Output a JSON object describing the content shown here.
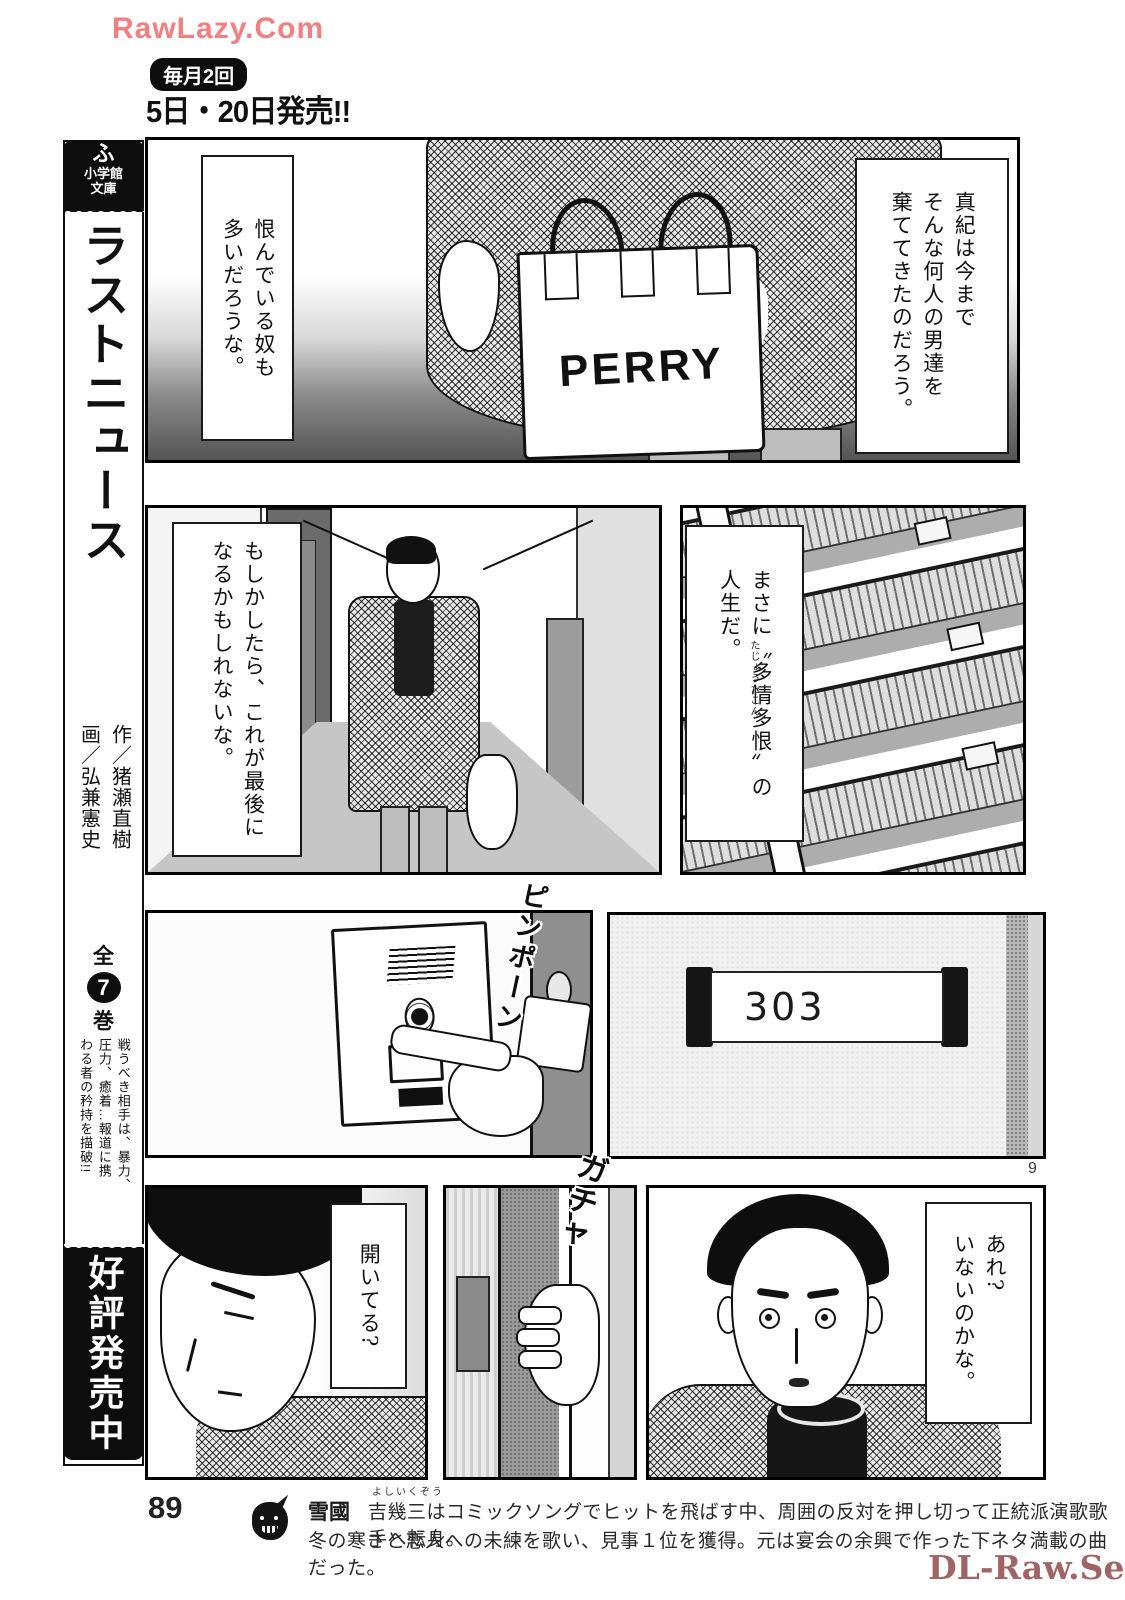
{
  "watermarks": {
    "top": "RawLazy.Com",
    "bottom": "DL-Raw.Se"
  },
  "header": {
    "frequency_badge": "毎月2回",
    "release_dates": "5日・20日発売!!"
  },
  "sidebar": {
    "publisher_mark": "ふ",
    "publisher_name": "小学館\n文庫",
    "series_title": "ラストニュース",
    "credits": "作／猪瀬直樹\n画／弘兼憲史",
    "volumes": {
      "prefix": "全",
      "count": "7",
      "suffix": "巻"
    },
    "tagline": "戦うべき相手は、暴力、\n圧力、癒着…報道に携\nわる者の矜持を描破!!",
    "availability_badge": "好評発売中"
  },
  "panels": {
    "panel1": {
      "caption_right": "真紀は今まで\nそんな何人の男達を\n棄ててきたのだろう。",
      "caption_left": "恨んでいる奴も\n多いだろうな。",
      "bag_label": "PERRY"
    },
    "panel2": {
      "caption": "もしかしたら、これが最後に\nなるかもしれないな。"
    },
    "panel3": {
      "caption": "まさに〝多情多恨〟の\n人生だ。",
      "furigana": "たじょうたこん"
    },
    "panel4": {
      "sfx": "ピンポーン"
    },
    "panel5": {
      "room_number": "303"
    },
    "panel6": {
      "caption": "開いてる?"
    },
    "panel7": {
      "sfx": "ガチャ"
    },
    "panel8": {
      "caption": "あれ?\nいないのかな。"
    }
  },
  "page_numbers": {
    "corner": "9",
    "footer": "89"
  },
  "footer": {
    "song_title": "雪國",
    "furigana": "よしいくぞう",
    "line1": "吉幾三はコミックソングでヒットを飛ばす中、周囲の反対を押し切って正統派演歌歌手へ転身。",
    "line2": "冬の寒さと恋人への未練を歌い、見事１位を獲得。元は宴会の余興で作った下ネタ満載の曲だった。"
  },
  "colors": {
    "watermark_top": "#f28080",
    "watermark_bottom": "#a06464",
    "ink": "#111111"
  }
}
